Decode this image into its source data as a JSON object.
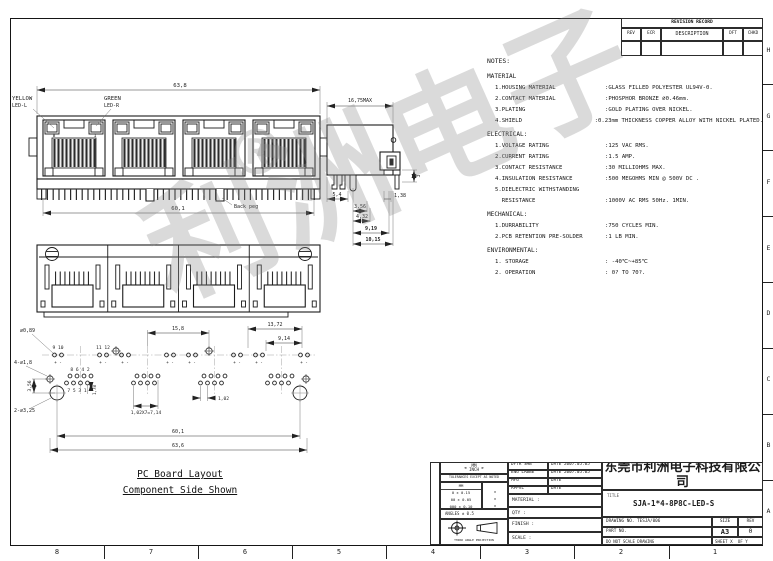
{
  "sheet": {
    "grid_numbers": [
      "8",
      "7",
      "6",
      "5",
      "4",
      "3",
      "2",
      "1"
    ],
    "grid_letters": [
      "H",
      "G",
      "F",
      "E",
      "D",
      "C",
      "B",
      "A"
    ]
  },
  "watermark": {
    "text": "利洲电子",
    "reg": "®"
  },
  "revision_table": {
    "title": "REVISION RECORD",
    "col_rev": "REV",
    "col_ecr": "ECR",
    "col_desc": "DESCRIPTION",
    "col_dft": "DFT",
    "col_chkd": "CHKD"
  },
  "front_view": {
    "dim_top": "63,8",
    "dim_bottom": "60,1",
    "led_left_1": "YELLOW",
    "led_left_2": "LED-L",
    "led_right_1": "GREEN",
    "led_right_2": "LED-R",
    "pin_8": "8",
    "pin_1": "1",
    "back_peg": "Back peg"
  },
  "side_view": {
    "dim_width": "16,75MAX",
    "dim_a": "5,4",
    "dim_b": "1,38",
    "dim_c": "3",
    "dim_d": "3,56",
    "dim_e": "4,32",
    "dim_f": "9,19",
    "dim_g": "10,15"
  },
  "pcb": {
    "caption_1": "PC Board Layout",
    "caption_2": "Component Side Shown",
    "hole_led": "⌀0,89",
    "hole_small": "4-⌀1,8",
    "hole_big": "2-⌀3,25",
    "pins_9_10": "9 10",
    "pins_11_12": "11 12",
    "pol": "+ -",
    "pins_even": "8 6 4 2",
    "pins_odd": "7 5 3 1",
    "dim_vert": "3,56",
    "dim_pin1": "1,78",
    "dim_15_8": "15,8",
    "dim_13_72": "13,72",
    "dim_9_14": "9,14",
    "dim_1_02": "1,02",
    "dim_pitch": "1,02X7=7,14",
    "dim_60_1": "60,1",
    "dim_63_6": "63,6"
  },
  "notes": {
    "heading": "NOTES:",
    "material_title": "MATERIAL",
    "material": [
      {
        "label": "1.HOUSING MATERIAL",
        "value": ":GLASS FILLED POLYESTER UL94V-0."
      },
      {
        "label": "2.CONTACT MATERIAL",
        "value": ":PHOSPHOR BRONZE ⌀0.46mm."
      },
      {
        "label": "3.PLATING",
        "value": ":GOLD PLATING OVER NICKEL."
      },
      {
        "label": "4.SHIELD",
        "value": ":0.23mm THICKNESS COPPER ALLOY WITH NICKEL PLATED."
      }
    ],
    "electrical_title": "ELECTRICAL:",
    "electrical": [
      {
        "label": "1.VOLTAGE RATING",
        "value": ":125 VAC RMS."
      },
      {
        "label": "2.CURRENT RATING",
        "value": ":1.5 AMP."
      },
      {
        "label": "3.CONTACT RESISTANCE",
        "value": ":30 MILLIOHMS MAX."
      },
      {
        "label": "4.INSULATION RESISTANCE",
        "value": ":500 MEGOHMS MIN @ 500V DC ."
      },
      {
        "label": "5.DIELECTRIC WITHSTANDING",
        "value": ""
      },
      {
        "label": "  RESISTANCE",
        "value": ":1000V AC RMS 50Hz. 1MIN."
      }
    ],
    "mechanical_title": "MECHANICAL:",
    "mechanical": [
      {
        "label": "1.DURRABILITY",
        "value": ":750 CYCLES MIN."
      },
      {
        "label": "2.PCB RETENTION PRE-SOLDER",
        "value": ":1 LB MIN."
      }
    ],
    "environmental_title": "ENVIRONMENTAL:",
    "environmental": [
      {
        "label": "1. STORAGE",
        "value": ": -40℃~+85℃"
      },
      {
        "label": "2. OPERATION",
        "value": ": 0? TO 70?."
      }
    ]
  },
  "title_block": {
    "company": "东莞市利洲电子科技有限公司",
    "title_label": "TITLE",
    "title": "SJA-1*4-8P8C-LED-S",
    "drawing_no_label": "DRAWING NO.",
    "drawing_no": "TESJA/006",
    "part_no_label": "PART NO.",
    "do_not_scale": "DO NOT SCALE DRAWING",
    "sheet_label": "SHEET",
    "sheet_x": "X",
    "of_label": "OF",
    "sheet_y": "Y",
    "size_label": "SIZE",
    "size": "A3",
    "rev_label": "REV",
    "rev": "0",
    "sign_rows": [
      {
        "label": "DFTR",
        "value": "SHB",
        "date_label": "DATE",
        "date": "2007.05.05"
      },
      {
        "label": "ENG",
        "value": "LABBE",
        "date_label": "DATE",
        "date": "2007.05.05"
      },
      {
        "label": "MFG",
        "value": "",
        "date_label": "DATE",
        "date": ""
      },
      {
        "label": "APPVL",
        "value": "",
        "date_label": "DATE",
        "date": ""
      }
    ],
    "material_label": "MATERIAL :",
    "qty_label": "QTY :",
    "finish_label": "FINISH :",
    "scale_label": "SCALE :",
    "units_mm": "MM",
    "units_inch": "INCH",
    "tol_heading": "TOLERANCES EXCEPT AS NOTED",
    "tol_col": "MM",
    "tol_rows": [
      "0 ± 0.15",
      "00 ± 0.05",
      "000 ± 0.10"
    ],
    "tol_marks": [
      "±",
      "±",
      "±"
    ],
    "angles": "ANGLES ± 0.5",
    "projection": "THIRD ANGLE PROJECTION"
  }
}
